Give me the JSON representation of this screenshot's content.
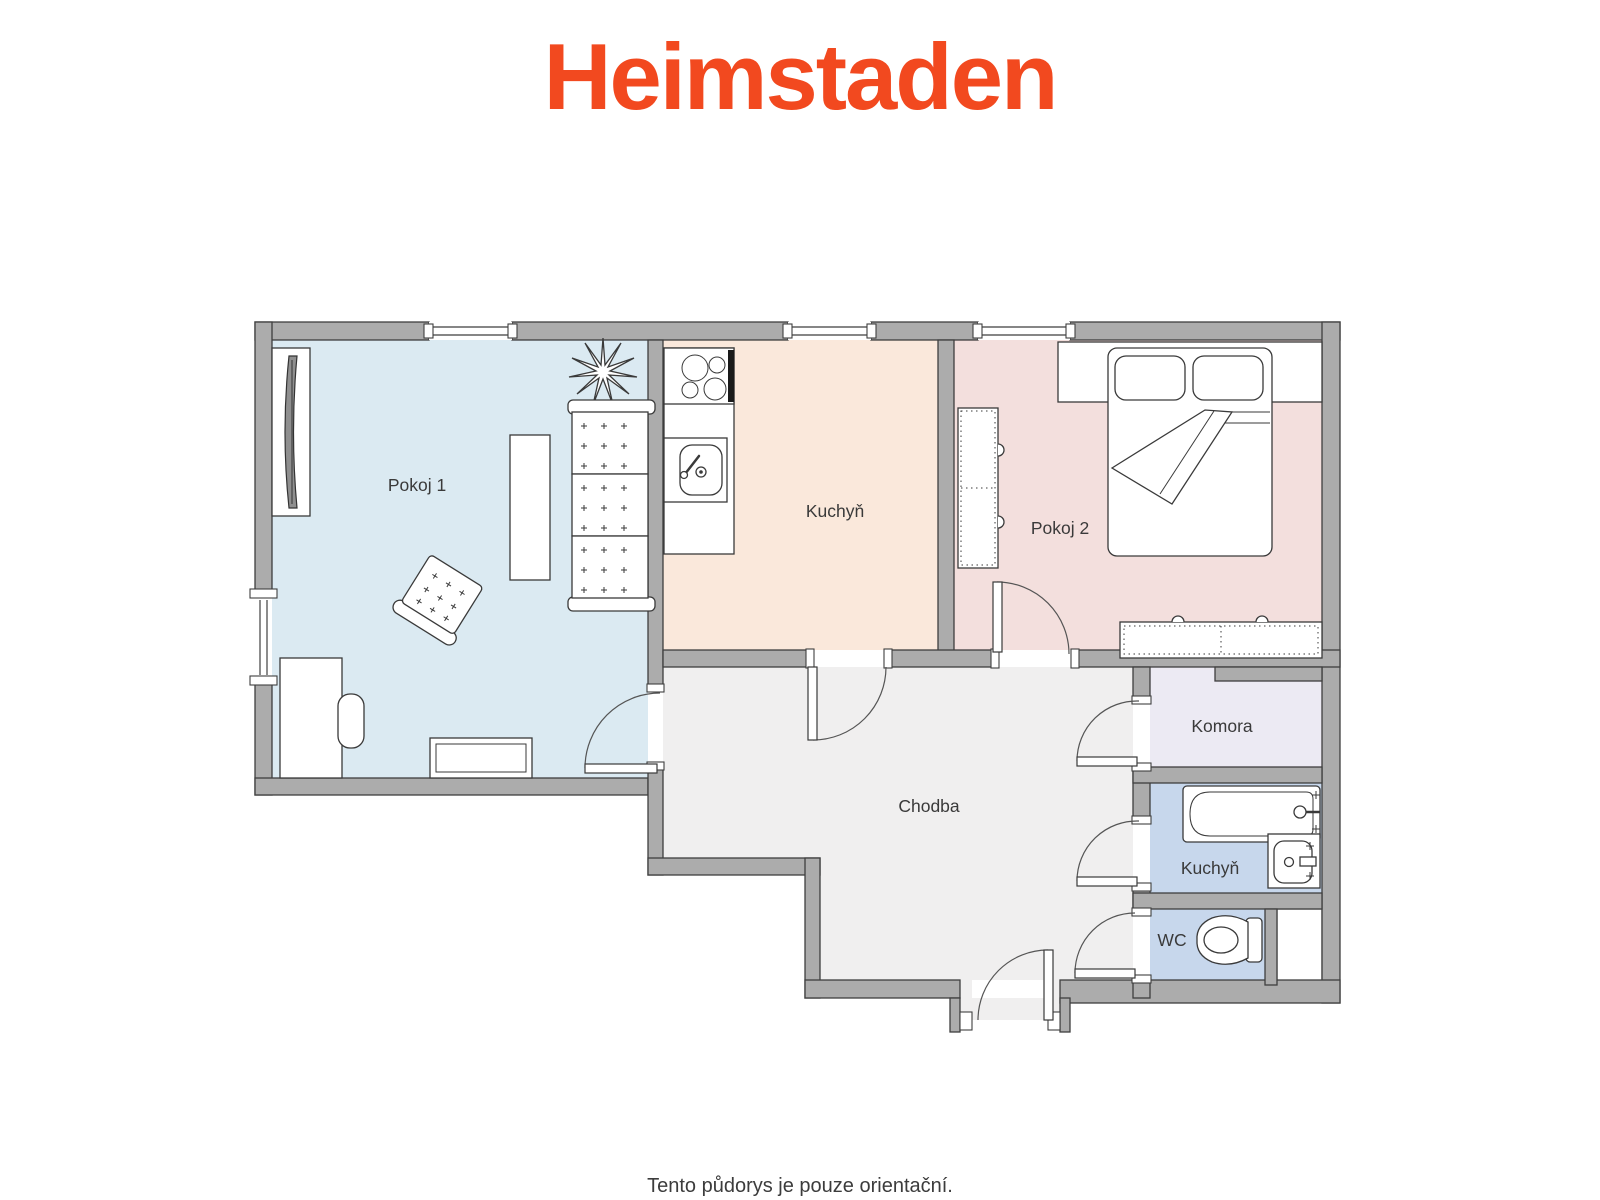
{
  "brand": {
    "logo_text": "Heimstaden",
    "logo_color": "#F2491F"
  },
  "footer": {
    "disclaimer": "Tento půdorys je pouze orientační.",
    "text_color": "#3C3C3C"
  },
  "floorplan": {
    "wall_color": "#ACACAC",
    "outline_color": "#3F3F3F",
    "rooms": [
      {
        "id": "pokoj-1",
        "label": "Pokoj 1",
        "color": "#DBEAF2"
      },
      {
        "id": "kuchyn",
        "label": "Kuchyň",
        "color": "#FAE8DB"
      },
      {
        "id": "pokoj-2",
        "label": "Pokoj 2",
        "color": "#F3DFDD"
      },
      {
        "id": "chodba",
        "label": "Chodba",
        "color": "#F0EFEF"
      },
      {
        "id": "komora",
        "label": "Komora",
        "color": "#ECEAF3"
      },
      {
        "id": "koupelna",
        "label": "Kuchyň",
        "color": "#C7D7EC"
      },
      {
        "id": "wc",
        "label": "WC",
        "color": "#C7D7EC"
      }
    ]
  }
}
